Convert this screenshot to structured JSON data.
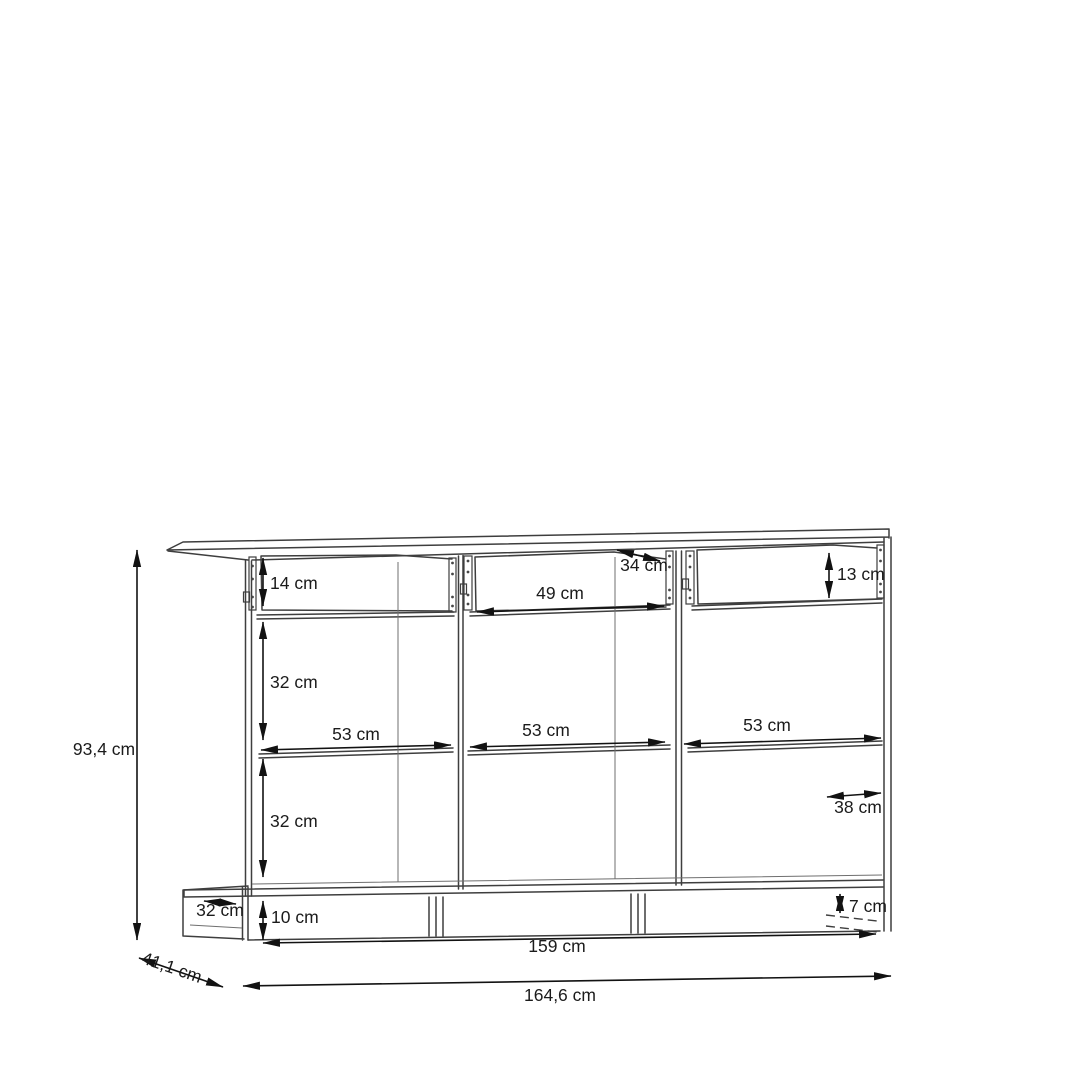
{
  "diagram": {
    "unit": "cm",
    "colors": {
      "background": "#ffffff",
      "structure_line": "#3e3e3e",
      "dimension_line": "#121212",
      "text": "#1b1b1b"
    },
    "dimensions": {
      "overall_height": "93,4 cm",
      "overall_depth": "41,1 cm",
      "overall_width": "164,6 cm",
      "base_width": "159 cm",
      "left_drawer_height": "14 cm",
      "middle_drawer_width": "49 cm",
      "middle_drawer_depth": "34 cm",
      "right_drawer_height": "13 cm",
      "upper_compartment_height": "32 cm",
      "lower_compartment_height": "32 cm",
      "left_compartment_width": "53 cm",
      "middle_compartment_width": "53 cm",
      "right_compartment_width": "53 cm",
      "right_compartment_depth": "38 cm",
      "plinth_depth": "32 cm",
      "plinth_height": "10 cm",
      "plinth_rear_height": "7 cm"
    }
  }
}
